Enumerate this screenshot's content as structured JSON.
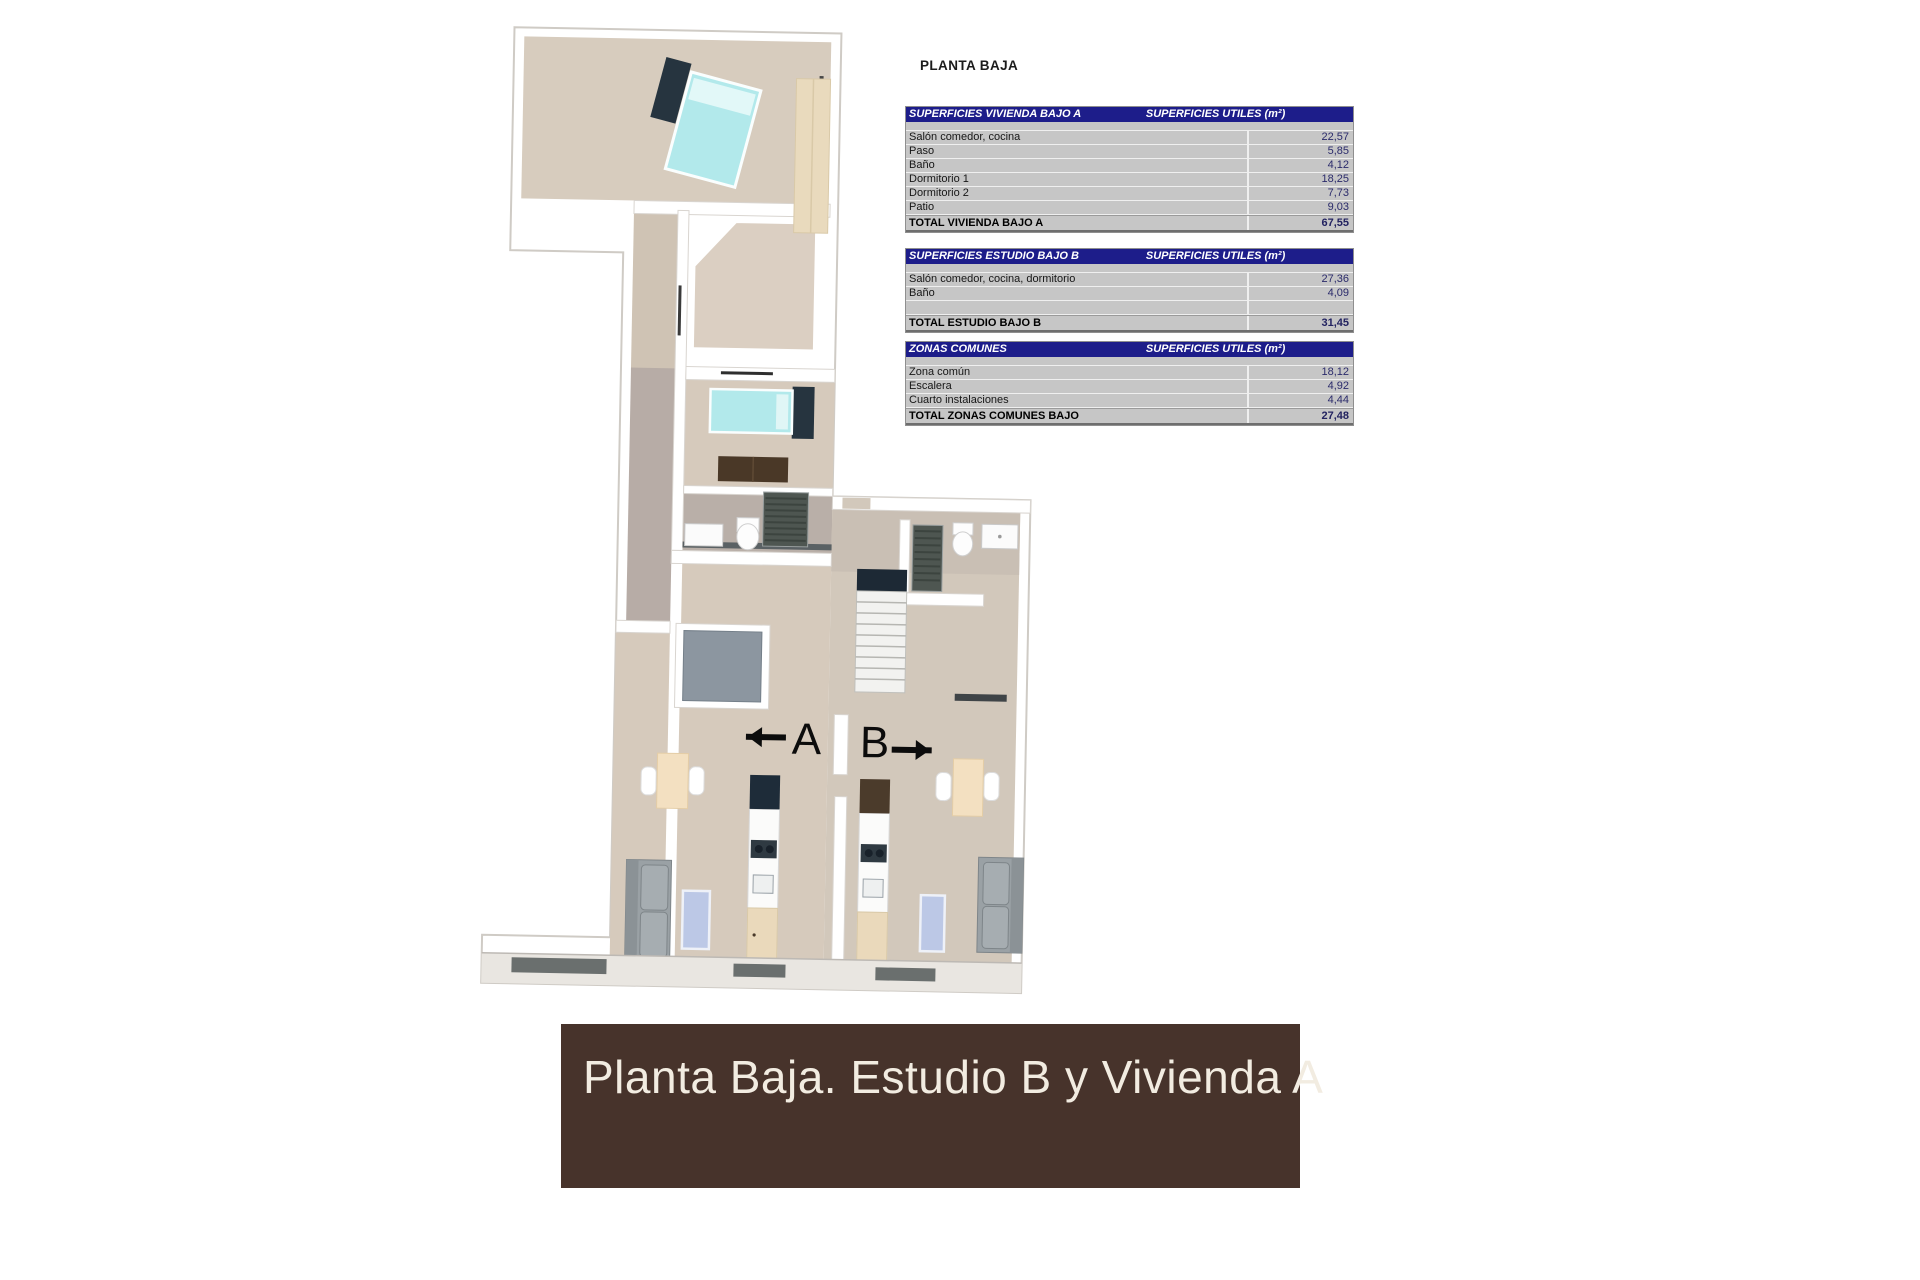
{
  "plan_title": "PLANTA BAJA",
  "tables": [
    {
      "title": "SUPERFICIES VIVIENDA BAJO A",
      "units_header": "SUPERFICIES UTILES  (m²)",
      "rows": [
        {
          "label": "Salón comedor, cocina",
          "value": "22,57"
        },
        {
          "label": "Paso",
          "value": "5,85"
        },
        {
          "label": "Baño",
          "value": "4,12"
        },
        {
          "label": "Dormitorio 1",
          "value": "18,25"
        },
        {
          "label": "Dormitorio 2",
          "value": "7,73"
        },
        {
          "label": "Patio",
          "value": "9,03"
        }
      ],
      "total": {
        "label": "TOTAL VIVIENDA BAJO A",
        "value": "67,55"
      }
    },
    {
      "title": "SUPERFICIES ESTUDIO BAJO B",
      "units_header": "SUPERFICIES UTILES  (m²)",
      "rows": [
        {
          "label": "Salón comedor, cocina, dormitorio",
          "value": "27,36"
        },
        {
          "label": "Baño",
          "value": "4,09"
        }
      ],
      "total": {
        "label": "TOTAL ESTUDIO BAJO B",
        "value": "31,45"
      }
    },
    {
      "title": "ZONAS COMUNES",
      "units_header": "SUPERFICIES UTILES  (m²)",
      "rows": [
        {
          "label": "Zona común",
          "value": "18,12"
        },
        {
          "label": "Escalera",
          "value": "4,92"
        },
        {
          "label": "Cuarto instalaciones",
          "value": "4,44"
        }
      ],
      "total": {
        "label": "TOTAL ZONAS COMUNES BAJO",
        "value": "27,48"
      }
    }
  ],
  "floor_plan": {
    "unit_a_label": "A",
    "unit_b_label": "B"
  },
  "banner": {
    "text": "Planta Baja. Estudio B y Vivienda A"
  },
  "colors": {
    "table_header_bg": "#1d1d8a",
    "table_row_bg": "#c6c6c6",
    "value_text": "#2b2b6b",
    "banner_bg": "#47332b",
    "banner_text": "#f2ece1",
    "floor_beige": "#d6cabc",
    "hall_gray": "#b7aca6",
    "bed_cyan": "#b2e9eb",
    "wardrobe_tan": "#e9dabd",
    "wardrobe_brown": "#4a3827",
    "kitchen_dark": "#1e2c39",
    "rug_blue": "#bcc8e6",
    "sofa_gray": "#9aa1a5"
  }
}
